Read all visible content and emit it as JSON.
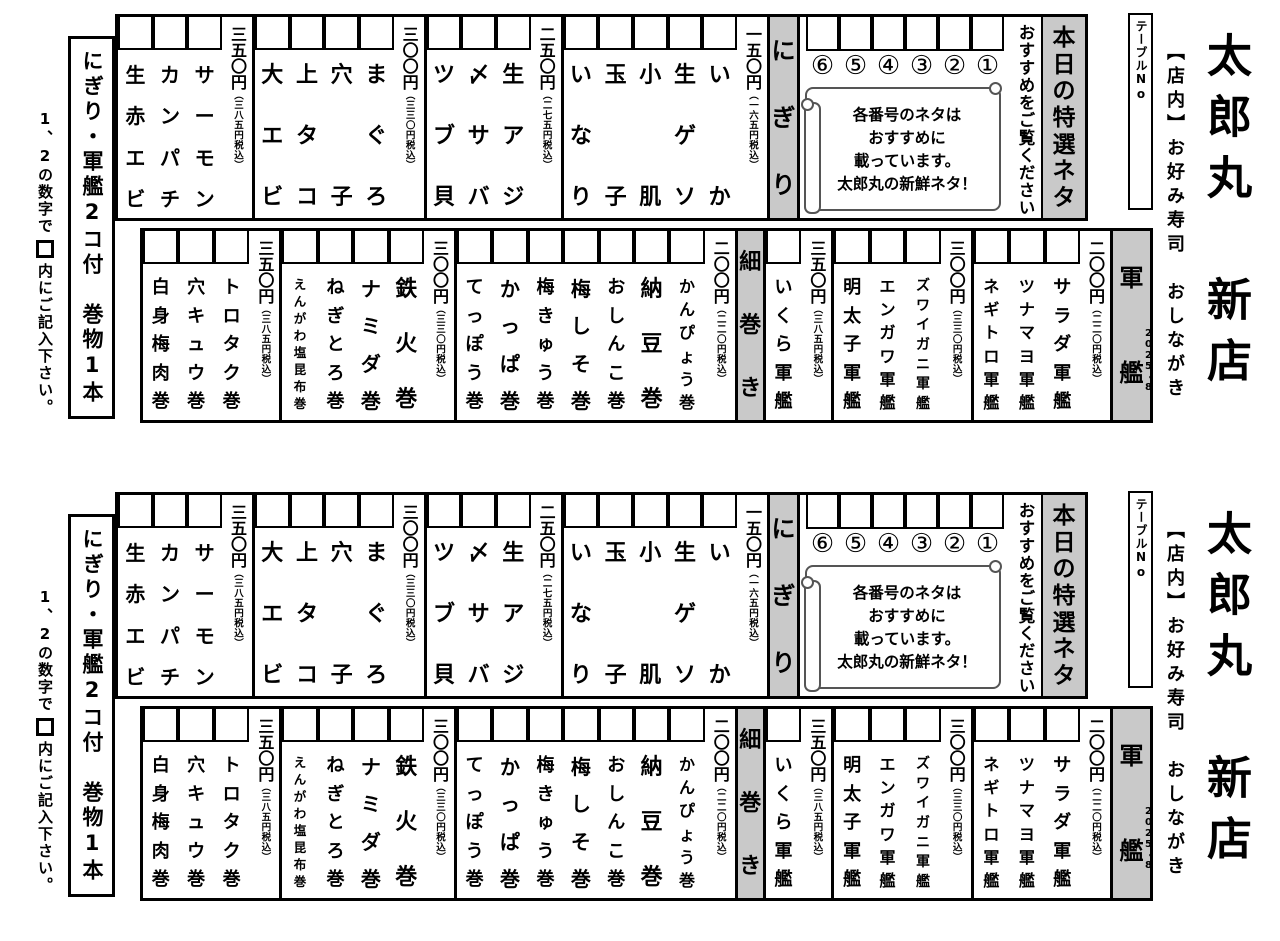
{
  "page": {
    "title": "太郎丸　新店",
    "subtitle": "【店内】お好み寿司　おしながき",
    "edition": "2025・8",
    "table_no": "テーブルNo",
    "instruction_pre": "1、2の数字で",
    "instruction_post": "内にご記入下さい。",
    "left_label": "にぎり・軍艦2コ付　巻物1本",
    "header_bg": "#c9c9c9"
  },
  "special": {
    "header": "本日の特選ネタ",
    "note": "おすすめをご覧ください",
    "numbers": [
      "①",
      "②",
      "③",
      "④",
      "⑤",
      "⑥"
    ],
    "scroll_lines": [
      "各番号のネタは",
      "おすすめに",
      "載っています。",
      "太郎丸の新鮮ネタ！"
    ]
  },
  "nigiri": {
    "header": "にぎり",
    "groups": [
      {
        "price": "一五〇円",
        "tax": "（一六五円税込）",
        "items": [
          "いか",
          "生ゲソ",
          "小肌",
          "玉子",
          "いなり"
        ]
      },
      {
        "price": "二五〇円",
        "tax": "（二七五円税込）",
        "items": [
          "生アジ",
          "〆サバ",
          "ツブ貝"
        ]
      },
      {
        "price": "三〇〇円",
        "tax": "（三三〇円税込）",
        "items": [
          "まぐろ",
          "穴子",
          "上タコ",
          "大エビ"
        ]
      },
      {
        "price": "三五〇円",
        "tax": "（三八五円税込）",
        "items": [
          "サーモン",
          "カンパチ",
          "生赤エビ"
        ]
      }
    ]
  },
  "gunkan": {
    "header": "軍艦",
    "groups": [
      {
        "price": "二〇〇円",
        "tax": "（二二〇円税込）",
        "items": [
          "サラダ軍艦",
          "ツナマヨ軍艦",
          "ネギトロ軍艦"
        ]
      },
      {
        "price": "三〇〇円",
        "tax": "（三三〇円税込）",
        "items": [
          "ズワイガニ軍艦",
          "エンガワ軍艦",
          "明太子軍艦"
        ]
      },
      {
        "price": "三五〇円",
        "tax": "（三八五円税込）",
        "items": [
          "いくら軍艦"
        ]
      }
    ]
  },
  "hosomaki": {
    "header": "細巻き",
    "groups": [
      {
        "price": "二〇〇円",
        "tax": "（二二〇円税込）",
        "items": [
          "かんぴょう巻",
          "納豆巻",
          "おしんこ巻",
          "梅しそ巻",
          "梅きゅう巻",
          "かっぱ巻",
          "てっぽう巻"
        ]
      },
      {
        "price": "三〇〇円",
        "tax": "（三三〇円税込）",
        "items": [
          "鉄火巻",
          "ナミダ巻",
          "ねぎとろ巻",
          "えんがわ塩昆布巻"
        ]
      },
      {
        "price": "三五〇円",
        "tax": "（三八五円税込）",
        "items": [
          "トロタク巻",
          "穴キュウ巻",
          "白身梅肉巻"
        ]
      }
    ]
  }
}
